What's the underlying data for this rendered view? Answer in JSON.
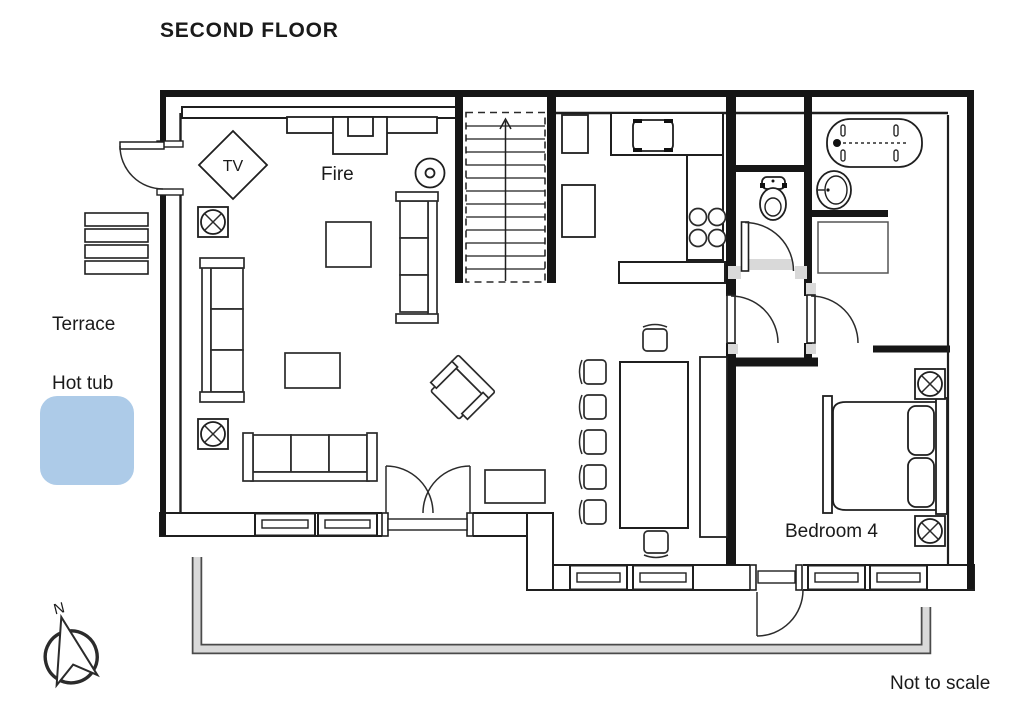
{
  "title": "SECOND FLOOR",
  "labels": {
    "tv": "TV",
    "fire": "Fire",
    "terrace": "Terrace",
    "hot_tub": "Hot tub",
    "bedroom_4": "Bedroom 4",
    "north": "N",
    "scale_note": "Not to scale"
  },
  "colors": {
    "hot_tub_fill": "#adcbe8",
    "railing_fill": "#d9d9d9",
    "railing_edge": "#4a4a4a",
    "threshold_fill": "#d9d9d9",
    "note_text": "#9c9c9c"
  },
  "symbols": {
    "ceiling_light": "circled-x-in-square",
    "stairs_direction": "up-arrow",
    "compass": "north-arrow",
    "fireplace": "chimney-block",
    "hot_tub": "rounded-blue-square"
  }
}
